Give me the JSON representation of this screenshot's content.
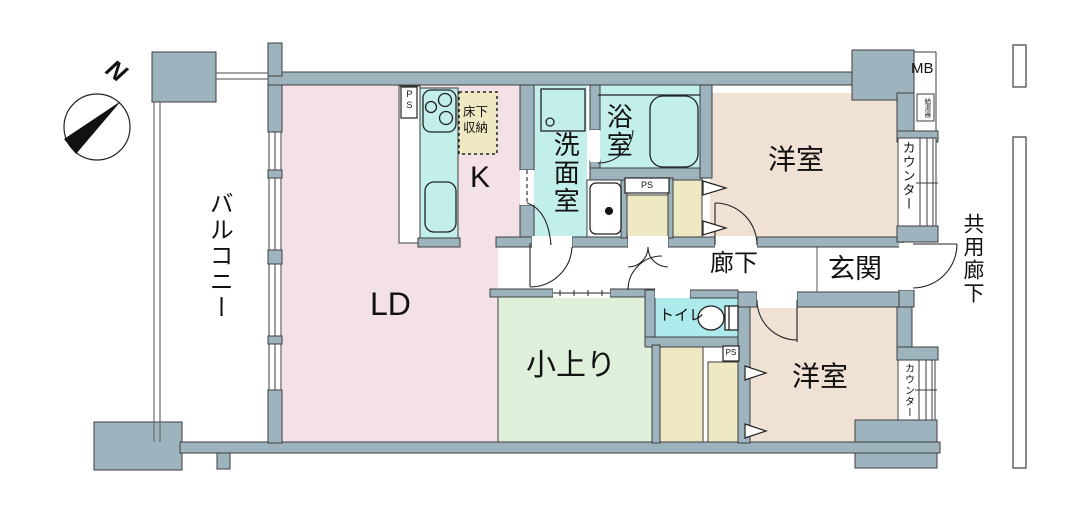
{
  "plan": {
    "compass": {
      "north": "N"
    },
    "rooms": {
      "balcony": "バルコニー",
      "living_dining": "LD",
      "kitchen": "K",
      "washroom": "洗面室",
      "bathroom": "浴室",
      "western_room_top": "洋室",
      "western_room_bottom": "洋室",
      "hallway": "廊下",
      "entrance": "玄関",
      "toilet": "トイレ",
      "raised_floor": "小上り",
      "common_corridor": "共用廊下"
    },
    "features": {
      "floor_storage_line1": "床下",
      "floor_storage_line2": "収納",
      "counter_top": "カウンター",
      "counter_bottom": "カウンター",
      "meter_box": "MB",
      "water_heater": "給湯器",
      "pipe_space_kitchen": "PS",
      "pipe_space_bath": "PS",
      "pipe_space_toilet": "PS"
    },
    "icons": [
      "compass-icon",
      "stove-icon",
      "kitchen-sink-icon",
      "washbasin-icon",
      "bathtub-icon",
      "washing-machine-pan-icon",
      "toilet-icon",
      "door-arc-icon",
      "folding-door-chevron-icon",
      "sliding-window-icon"
    ],
    "colors": {
      "wall": "#9db4be",
      "outline": "#3e3e3e",
      "living_dining": "#f3e1e7",
      "wet_area": "#c3efeb",
      "toilet": "#aeeaec",
      "western_room": "#f0e1d5",
      "raised_floor": "#dff0da",
      "closet": "#efe9c3"
    }
  }
}
